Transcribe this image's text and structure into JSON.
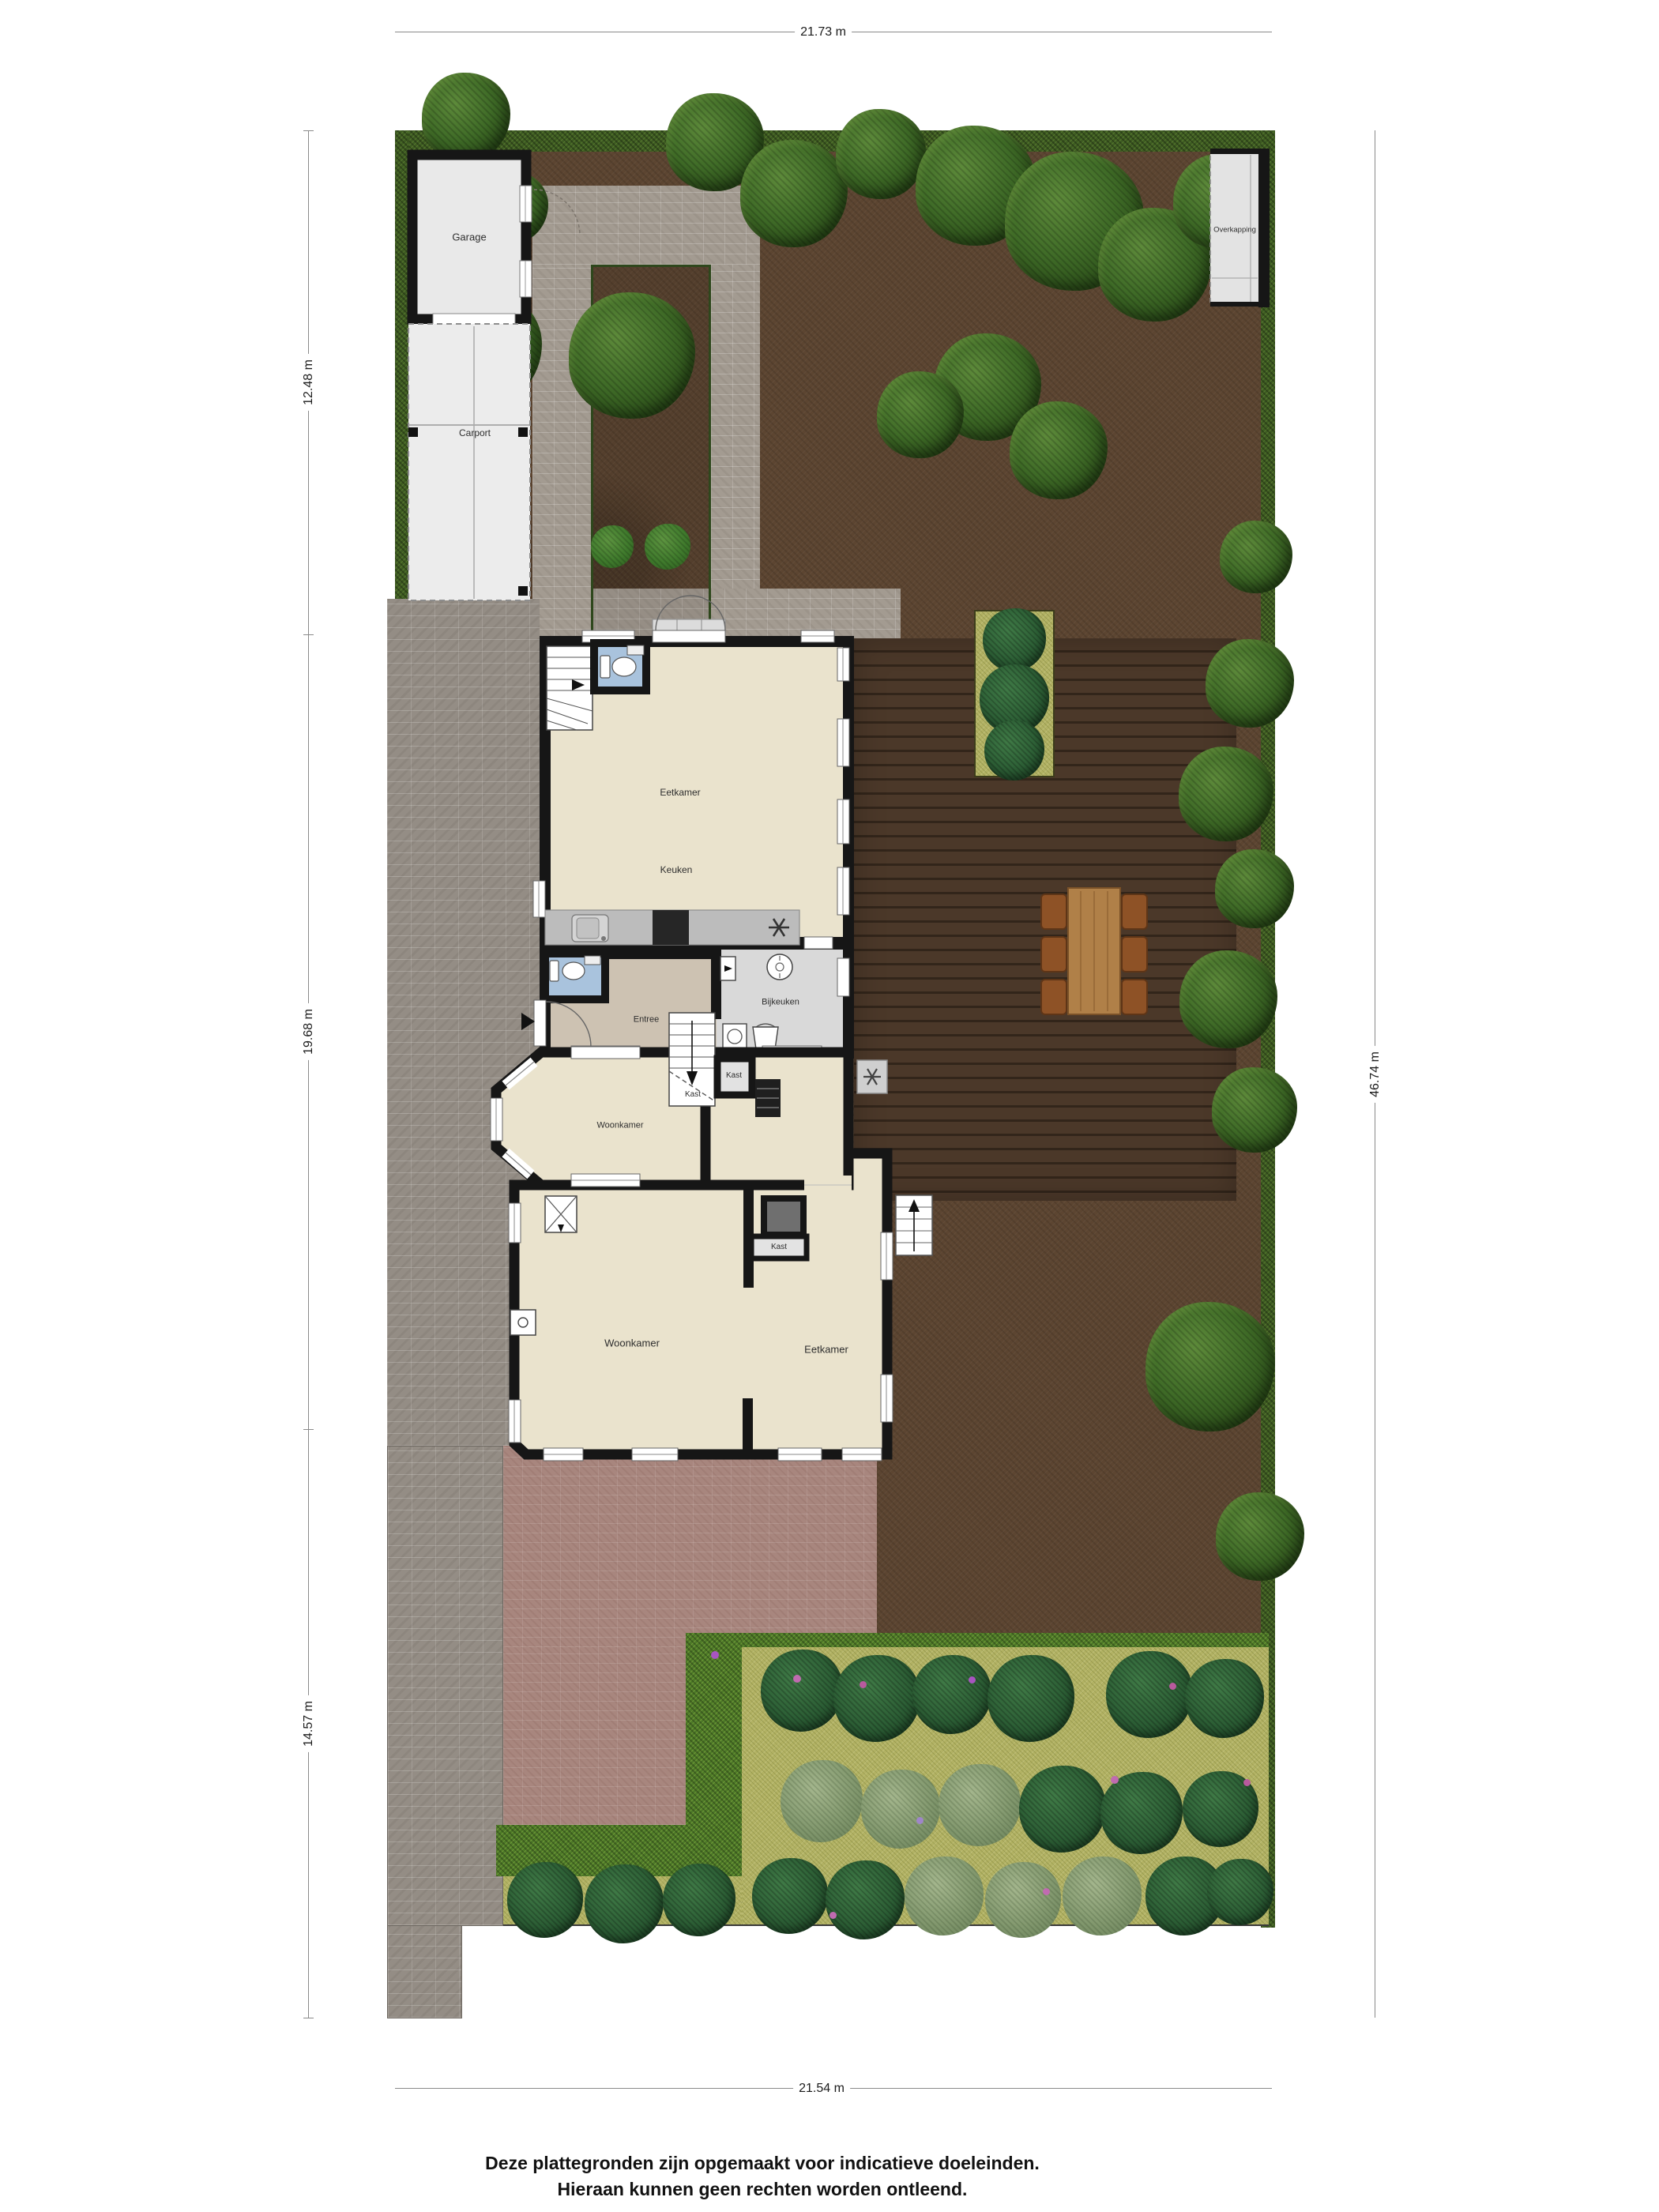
{
  "meta": {
    "type": "site-plan-floorplan",
    "floor": "ground floor with garden"
  },
  "dimensions": {
    "top": "21.73 m",
    "bottom": "21.54 m",
    "left_top": "12.48 m",
    "left_middle": "19.68 m",
    "left_bottom": "14.57 m",
    "right": "46.74 m"
  },
  "structures": {
    "garage": "Garage",
    "carport": "Carport",
    "overkapping": "Overkapping"
  },
  "rooms": {
    "dining_upper": "Eetkamer",
    "kitchen": "Keuken",
    "entry": "Entree",
    "utility": "Bijkeuken",
    "closet_under_stairs": "Kast",
    "closet_hall": "Kast",
    "closet_fireplace": "Kast",
    "living_bay": "Woonkamer",
    "living_main": "Woonkamer",
    "dining_main": "Eetkamer"
  },
  "disclaimer": {
    "line1": "Deze plattegronden zijn opgemaakt voor indicatieve doeleinden.",
    "line2": "Hieraan kunnen geen rechten worden ontleend."
  },
  "colors": {
    "soil": "#5c4531",
    "deck_wood": "#4b3829",
    "path_brick": "#a39b91",
    "driveway_brick": "#948d85",
    "terrace_mauve": "#a8867e",
    "hedge": "#3e5c22",
    "flower_lawn": "#b2b264",
    "floor_cream": "#eae3cd",
    "floor_entry_tan": "#cdc2b2",
    "floor_utility_grey": "#d9d9d9",
    "toilet_blue": "#a9c3dd",
    "wall_black": "#161616",
    "garden_table": "#b08048"
  }
}
